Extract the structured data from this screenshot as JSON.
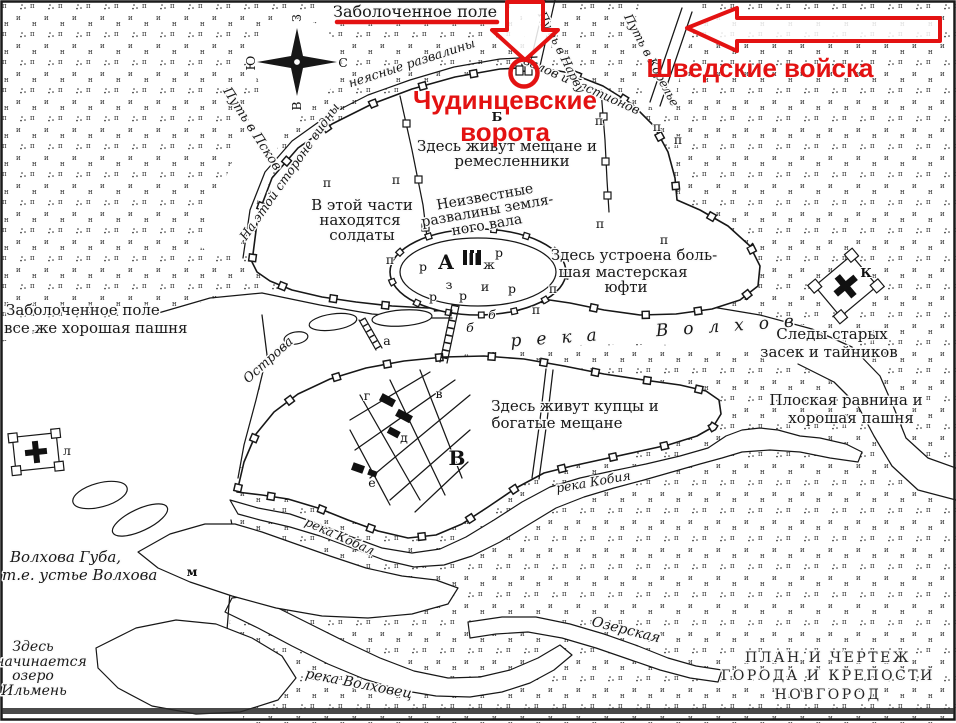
{
  "colors": {
    "annotation_red": "#e31212",
    "ink": "#171717",
    "paper": "#ffffff"
  },
  "annotations": {
    "gate_label_line1": "Чудинцевские",
    "gate_label_line2": "ворота",
    "swedish_troops": "Шведские войска"
  },
  "compass": {
    "north": "С",
    "south": "Ю",
    "west": "З",
    "east": "В"
  },
  "labels": {
    "swamp_top": "Заболоченное поле",
    "swamp_left_1": "Заболоченное поле",
    "swamp_left_2": "все же хорошая пашня",
    "path_pskov": "Путь в Псков",
    "path_narva": "Путь в Нарву",
    "path_korela": "Путь в Корелье",
    "wall_ruins_1": "На этой стороне видны",
    "wall_ruins_2": "неясные развалины",
    "wall_ruins_3": "валов и бастионов",
    "burghers_1": "Здесь живут мещане и",
    "burghers_2": "ремесленники",
    "soldiers_1": "В этой части",
    "soldiers_2": "находятся",
    "soldiers_3": "солдаты",
    "ruins_unknown_1": "Неизвестные",
    "ruins_unknown_2": "развалины земля-",
    "ruins_unknown_3": "ного вала",
    "workshop_1": "Здесь устроена боль-",
    "workshop_2": "шая мастерская",
    "workshop_3": "юфти",
    "river_volkhov": "река Волхов",
    "islands": "Острова",
    "traces_1": "Следы старых",
    "traces_2": "засек и тайников",
    "plain_1": "Плоская равнина и",
    "plain_2": "хорошая пашня",
    "merchants_1": "Здесь живут купцы и",
    "merchants_2": "богатые мещане",
    "river_kobia": "река Кобия",
    "river_kobal": "река Кобал",
    "volkhov_bay_1": "Волхова Губа,",
    "volkhov_bay_2": "т.е. устье Волхова",
    "lake_1": "Здесь",
    "lake_2": "начинается",
    "lake_3": "озеро",
    "lake_4": "Ильмень",
    "ozerskaya": "Озерская",
    "river_volkhovets": "река Волховец",
    "title_1": "ПЛАН И ЧЕРТЕЖ",
    "title_2": "ГОРОДА И КРЕПОСТИ",
    "title_3": "НОВГОРОД"
  },
  "map_letters": {
    "A": "А",
    "B": "Б",
    "V": "В",
    "K": "К",
    "a": "а",
    "b": "б",
    "v": "в",
    "g": "г",
    "d": "д",
    "e": "е",
    "zh": "ж",
    "z": "з",
    "i": "и",
    "l": "л",
    "m": "м",
    "p": "п",
    "r": "р"
  }
}
